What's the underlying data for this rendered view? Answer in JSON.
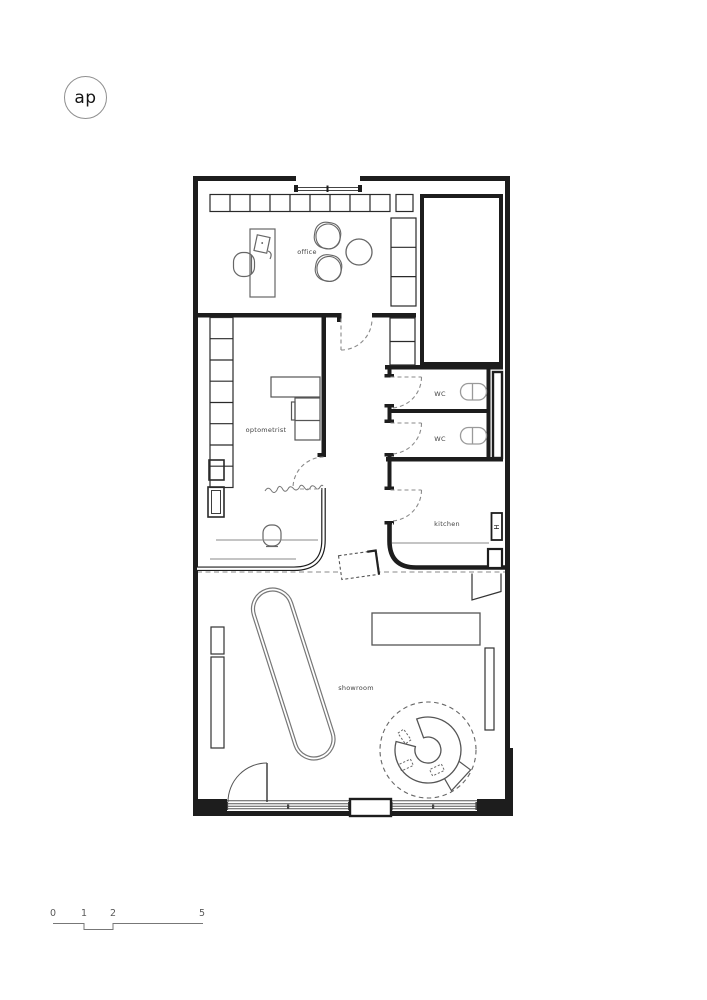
{
  "logo": {
    "text": "ap"
  },
  "rooms": {
    "office": "office",
    "optometrist": "optometrist",
    "wc_top": "WC",
    "wc_bottom": "WC",
    "kitchen": "kitchen",
    "showroom": "showroom"
  },
  "kitchen_appliance_symbol": "H",
  "scale_bar": {
    "ticks": [
      "0",
      "1",
      "2",
      "5"
    ]
  },
  "colors": {
    "wall": "#1d1d1d",
    "furniture_line": "#666666",
    "dashed_line": "#8a8a8a",
    "label_text": "#424242"
  }
}
